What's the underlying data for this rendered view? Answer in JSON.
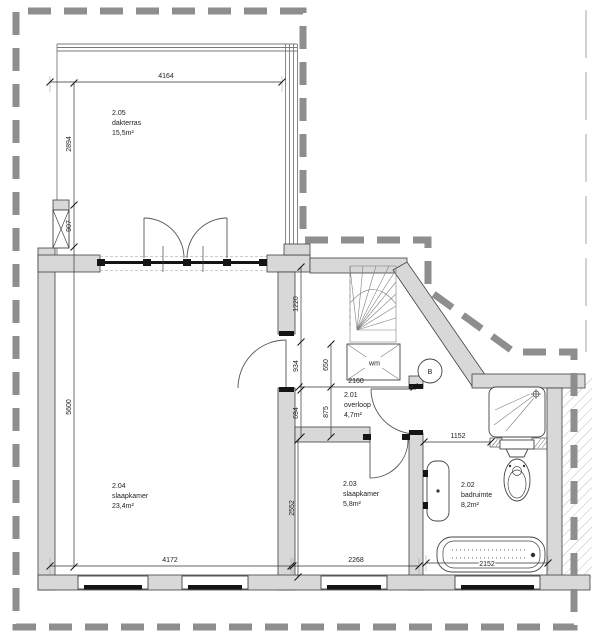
{
  "plan": {
    "rooms": [
      {
        "number": "2.05",
        "name": "dakterras",
        "area": "15,5m²"
      },
      {
        "number": "2.04",
        "name": "slaapkamer",
        "area": "23,4m²"
      },
      {
        "number": "2.03",
        "name": "slaapkamer",
        "area": "5,8m²"
      },
      {
        "number": "2.01",
        "name": "overloop",
        "area": "4,7m²"
      },
      {
        "number": "2.02",
        "name": "badruimte",
        "area": "8,2m²"
      }
    ],
    "dimensions": {
      "terrace_width": "4164",
      "terrace_depth": "2894",
      "terrace_wall": "907",
      "bedroom_depth": "5600",
      "stair_opening": "1220",
      "landing_934": "934",
      "landing_694": "694",
      "landing_650": "650",
      "landing_875": "875",
      "landing_width": "2160",
      "bath_niche": "1152",
      "bedroom_width": "4172",
      "bedroom2_width": "2268",
      "bath_width": "2152",
      "bedroom2_depth": "2552"
    },
    "markers": {
      "washing_machine": "wm",
      "section": "B"
    },
    "colors": {
      "wall_fill": "#d8d8d8",
      "roofline_gray": "#8e8e8e",
      "glazing_black": "#141414"
    }
  }
}
